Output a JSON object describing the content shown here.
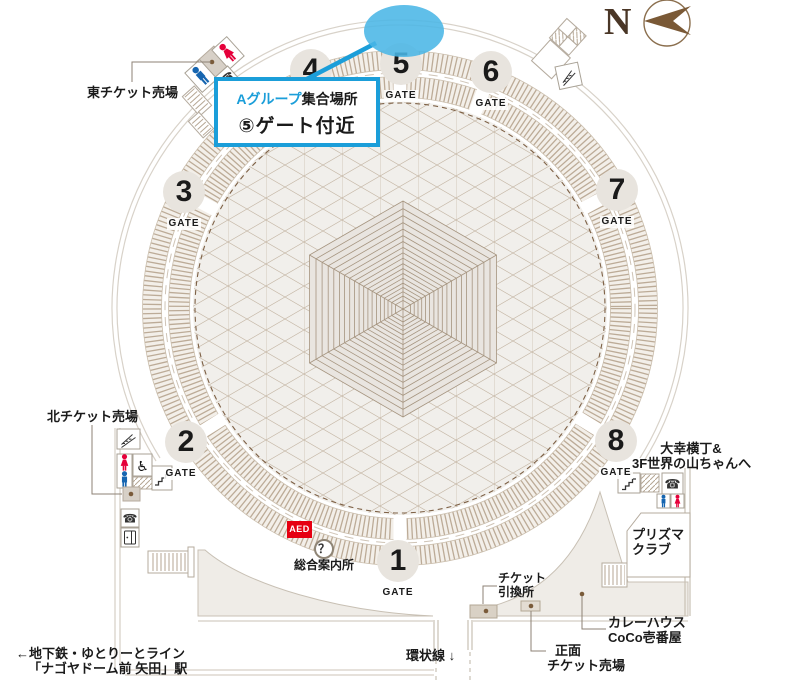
{
  "colors": {
    "accent_blue": "#1b9ed9",
    "ellipse_blue": "#4ab6e6",
    "aed_red": "#e60012",
    "male_blue": "#1665b0",
    "female_red": "#e5003a",
    "map_brown": "#8b7355",
    "text_black": "#1a1a1a"
  },
  "compass": {
    "north_label": "N"
  },
  "callout": {
    "group_label": "Aグループ",
    "meeting_label": "集合場所",
    "location": "⑤ゲート付近"
  },
  "gates": {
    "label": "GATE",
    "numbers": [
      "1",
      "2",
      "3",
      "4",
      "5",
      "6",
      "7",
      "8"
    ]
  },
  "icons": {
    "phone": "☎",
    "wheelchair": "♿"
  },
  "labels": {
    "east_ticket": "東チケット売場",
    "north_ticket": "北チケット売場",
    "station_line1": "←地下鉄・ゆとりーとライン",
    "station_line2": "「ナゴヤドーム前 矢田」駅",
    "ring_road": "環状線 ↓",
    "info_center": "総合案内所",
    "aed": "AED",
    "info_mark": "？",
    "ticket_exchange_line1": "チケット",
    "ticket_exchange_line2": "引換所",
    "front_ticket_line1": "正面",
    "front_ticket_line2": "チケット売場",
    "curry_line1": "カレーハウス",
    "curry_line2": "CoCo壱番屋",
    "prisma_line1": "プリズマ",
    "prisma_line2": "クラブ",
    "yokocho_line1": "大幸横丁&",
    "yokocho_line2": "3F世界の山ちゃんへ"
  }
}
